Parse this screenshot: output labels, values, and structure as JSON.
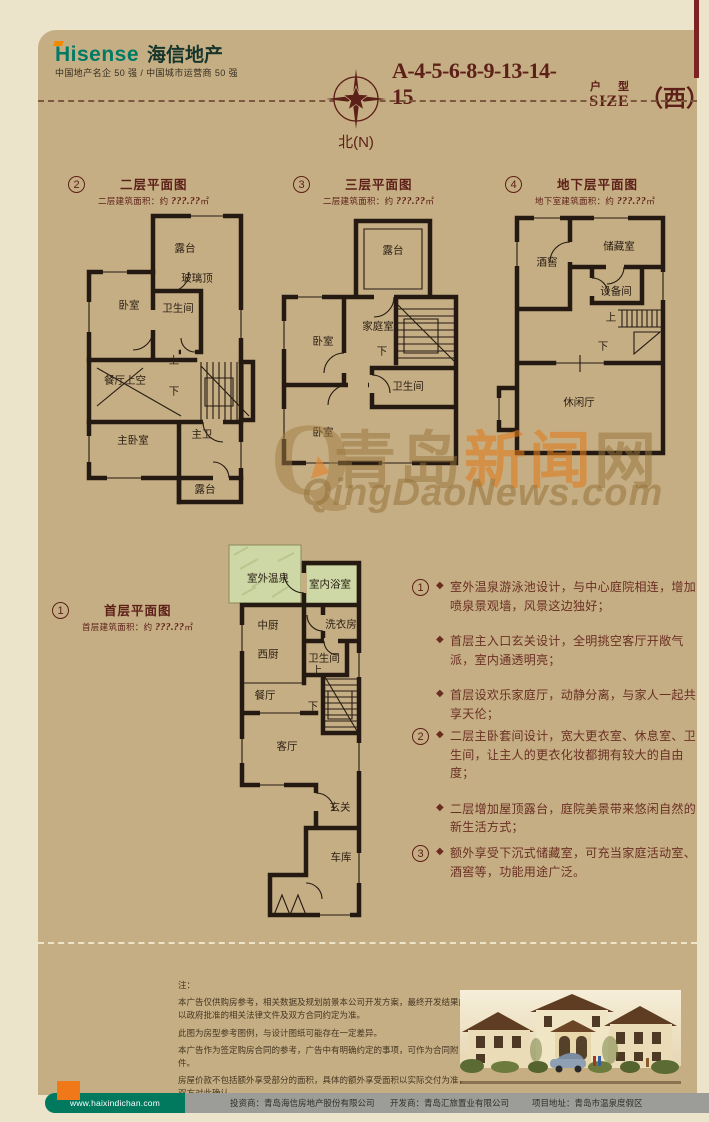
{
  "colors": {
    "bg": "#ece3cb",
    "panel": "#c6ae84",
    "maroon": "#5c2018",
    "wall": "#241a12",
    "pool_green": "#cdd8a6",
    "footer_green": "#00795f",
    "footer_orange": "#f07818",
    "watermark_orange": "#de7c1e",
    "watermark_tan": "#96743c"
  },
  "icons": {
    "bullet": "◆"
  },
  "header": {
    "brand_en": "Hisense",
    "brand_cn": "海信地产",
    "tagline": "中国地产名企 50 强 / 中国城市运营商 50 强",
    "code": "A-4-5-6-8-9-13-14-15",
    "type_cn": "户 型",
    "type_en": "SIZE",
    "orientation": "（西）",
    "compass_label": "北(N)"
  },
  "watermark": {
    "q": "Q",
    "cn_1": "青岛",
    "cn_2": "新闻",
    "cn_3": "网",
    "en": "QingDaoNews.com"
  },
  "plans": {
    "p1": {
      "num": "1",
      "title": "首层平面图",
      "area_label": "首层建筑面积：约 ",
      "area_value": "???.??",
      "area_unit": "㎡",
      "rooms": {
        "outdoor_spring": "室外温泉",
        "indoor_bath": "室内浴室",
        "kitchen_cn": "中厨",
        "kitchen_west": "西厨",
        "laundry": "洗衣房",
        "bathroom": "卫生间",
        "dining": "餐厅",
        "up": "上",
        "down": "下",
        "living": "客厅",
        "foyer": "玄关",
        "garage": "车库"
      }
    },
    "p2": {
      "num": "2",
      "title": "二层平面图",
      "area_label": "二层建筑面积：约 ",
      "area_value": "???.??",
      "area_unit": "㎡",
      "rooms": {
        "terrace_top": "露台",
        "glass_roof": "玻璃顶",
        "bedroom": "卧室",
        "bathroom": "卫生间",
        "dining_void": "餐厅上空",
        "up": "上",
        "down": "下",
        "master_bedroom": "主卧室",
        "master_bath": "主卫",
        "terrace_bottom": "露台"
      }
    },
    "p3": {
      "num": "3",
      "title": "三层平面图",
      "area_label": "二层建筑面积：约 ",
      "area_value": "???.??",
      "area_unit": "㎡",
      "rooms": {
        "terrace": "露台",
        "family_room": "家庭室",
        "bedroom_mid": "卧室",
        "down": "下",
        "bathroom": "卫生间",
        "bedroom_bottom": "卧室"
      }
    },
    "p4": {
      "num": "4",
      "title": "地下层平面图",
      "area_label": "地下室建筑面积：约 ",
      "area_value": "???.??",
      "area_unit": "㎡",
      "rooms": {
        "wine_cellar": "酒窖",
        "storage": "储藏室",
        "equipment": "设备间",
        "up": "上",
        "down": "下",
        "leisure_hall": "休闲厅"
      }
    }
  },
  "features": {
    "g1": {
      "num": "1",
      "items": [
        "室外温泉游泳池设计，与中心庭院相连，增加喷泉景观墙，风景这边独好；",
        "首层主入口玄关设计，全明挑空客厅开敞气派，室内通透明亮；",
        "首层设欢乐家庭厅，动静分离，与家人一起共享天伦；"
      ]
    },
    "g2": {
      "num": "2",
      "items": [
        "二层主卧套间设计，宽大更衣室、休息室、卫生间，让主人的更衣化妆都拥有较大的自由度；",
        "二层增加屋顶露台，庭院美景带来悠闲自然的新生活方式；"
      ]
    },
    "g3": {
      "num": "3",
      "items": [
        "额外享受下沉式储藏室，可充当家庭活动室、酒窖等，功能用途广泛。"
      ]
    }
  },
  "disclaimer": {
    "title": "注：",
    "lines": [
      "本广告仅供购房参考，相关数据及规划前景本公司开发方案，最终开发结果应以政府批准的相关法律文件及双方合同约定为准。",
      "此图为房型参考图例，与设计图纸可能存在一定差异。",
      "本广告作为签定购房合同的参考，广告中有明确约定的事项，可作为合同附件。",
      "房屋价款不包括额外享受部分的面积，具体的额外享受面积以实际交付为准，双方对此确认。"
    ]
  },
  "footer": {
    "url": "www.haixindichan.com",
    "investor": "投资商：青岛海信房地产股份有限公司",
    "developer": "开发商：青岛汇旅置业有限公司",
    "address": "项目地址：青岛市温泉度假区"
  }
}
